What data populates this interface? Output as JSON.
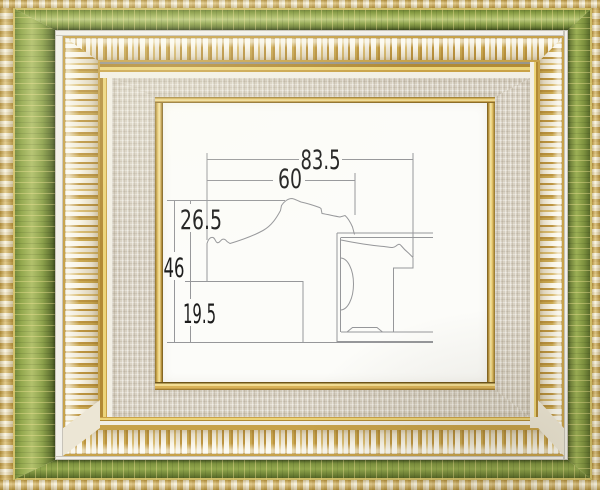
{
  "frame": {
    "style": "ornate green and gold picture frame with linen liner",
    "palette": {
      "green_band": "#7e9440",
      "gold_ornament": "#c9a24a",
      "ornament_white": "#efe9d8",
      "linen_liner": "#d9d2c4",
      "gold_fillet": "#e7c76c",
      "interior": "#fcfcf9"
    }
  },
  "diagram": {
    "line_color": "#96979a",
    "text_color": "#1c1c1c",
    "dimensions": [
      {
        "id": "overall-width",
        "value": "83.5"
      },
      {
        "id": "face-width",
        "value": "60"
      },
      {
        "id": "upper-height",
        "value": "26.5"
      },
      {
        "id": "overall-height",
        "value": "46"
      },
      {
        "id": "lower-height",
        "value": "19.5"
      }
    ]
  }
}
